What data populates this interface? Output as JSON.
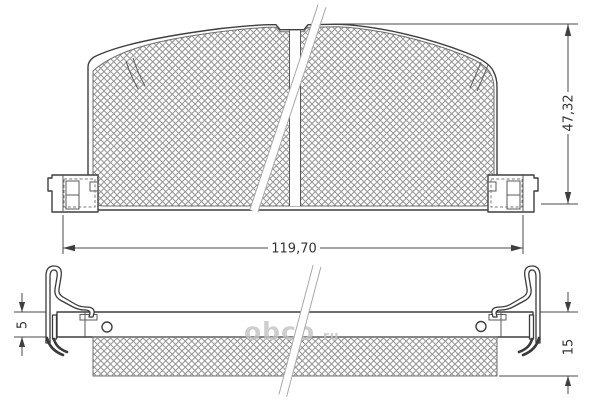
{
  "dimensions": {
    "overall_width": "119,70",
    "overall_height": "47,32",
    "backplate_thickness": "5",
    "total_thickness": "15"
  },
  "watermark": {
    "text": "obco",
    "suffix": "ru"
  },
  "colors": {
    "line": "#3f3f3f",
    "dimension_text": "#333333",
    "hatch": "#949494",
    "watermark": "#c3c3c3",
    "background": "#ffffff"
  }
}
